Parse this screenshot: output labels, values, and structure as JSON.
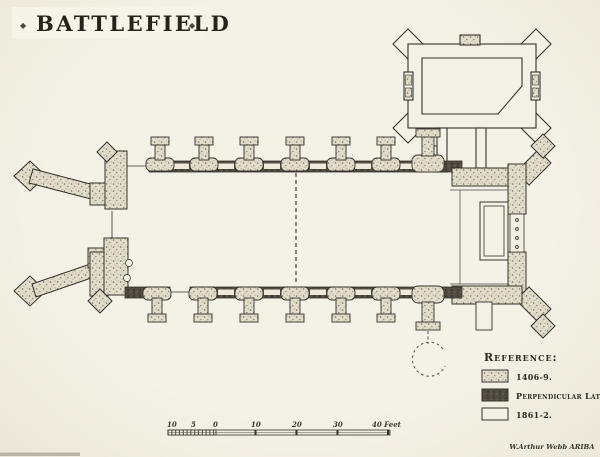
{
  "page": {
    "title": "BATTLEFIELD",
    "title_ornament": "◆",
    "signature": "W.Arthur Webb ARIBA"
  },
  "legend": {
    "heading": "Reference:",
    "items": [
      {
        "label": "1406-9.",
        "fill_style": "stipple-1406"
      },
      {
        "label": "Perpendicular Late",
        "fill_style": "dark-hatch-perpendicular"
      },
      {
        "label": "1861-2.",
        "fill_style": "plain-1861"
      }
    ]
  },
  "scale_bar": {
    "labels": [
      "10",
      "5",
      "0",
      "10",
      "20",
      "30"
    ],
    "end_label": "40 Feet"
  },
  "colors": {
    "paper": "#f1eee3",
    "ink": "#35322b",
    "stipple_fill": "#e2ddca",
    "hatch_fill": "#524e44"
  }
}
